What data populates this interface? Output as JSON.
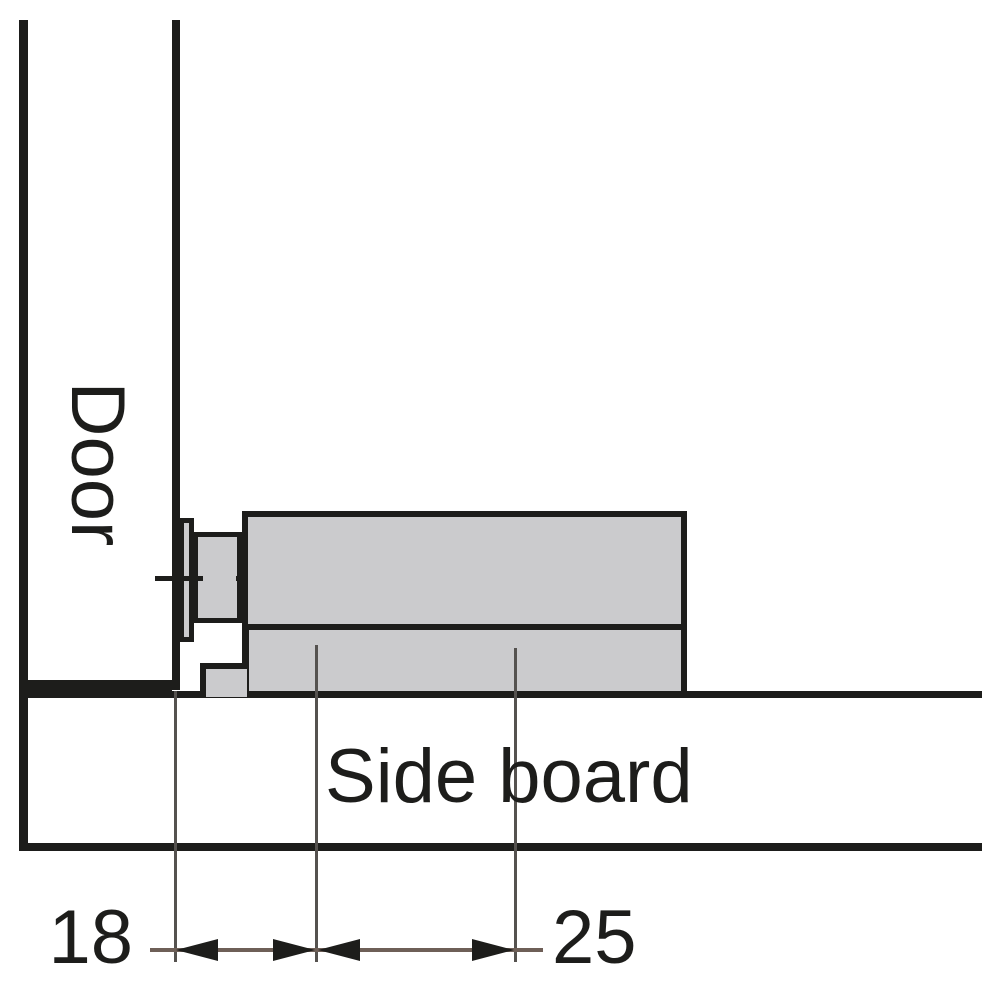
{
  "diagram": {
    "type": "technical-cross-section",
    "labels": {
      "door": "Door",
      "side_board": "Side board"
    },
    "dimensions": {
      "left_value": "18",
      "right_value": "25"
    },
    "colors": {
      "line": "#1d1d1b",
      "fill": "#cbcbcd",
      "thin": "#55524f",
      "dim": "#6e5f57",
      "background": "#ffffff"
    }
  }
}
